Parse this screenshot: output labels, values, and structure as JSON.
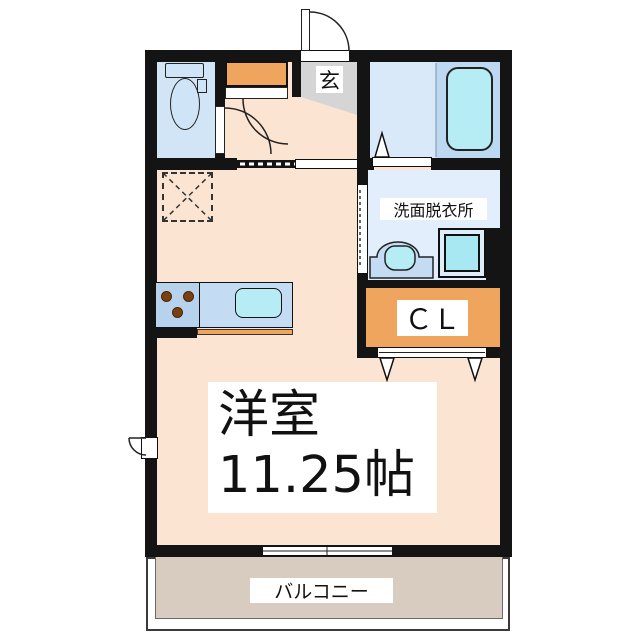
{
  "rooms": {
    "main": {
      "label_line1": "洋室",
      "label_line2": "11.25帖"
    },
    "entrance": {
      "label": "玄"
    },
    "washroom": {
      "label": "洗面脱衣所"
    },
    "closet": {
      "label": "ＣＬ"
    },
    "balcony": {
      "label": "バルコニー"
    }
  },
  "colors": {
    "wall": "#141414",
    "floor_main": "#fbe5d2",
    "floor_toilet": "#d2e5f7",
    "floor_bath": "#d9e9fa",
    "tub_zone": "#bdd9f1",
    "floor_washroom": "#e2eefb",
    "orange": "#efa55e",
    "entrance_gray": "#d5d5d5",
    "balcony_floor": "#d7ccbf",
    "fixture_blue": "#cfe4f6",
    "counter_blue": "#c3dcf3",
    "stove_blue": "#b7d2ed",
    "cyan": "#b6ecf4",
    "washer_cyan": "#a8e8f2",
    "washer_ring": "#ddeefa",
    "burner_brown": "#7c3f10"
  }
}
